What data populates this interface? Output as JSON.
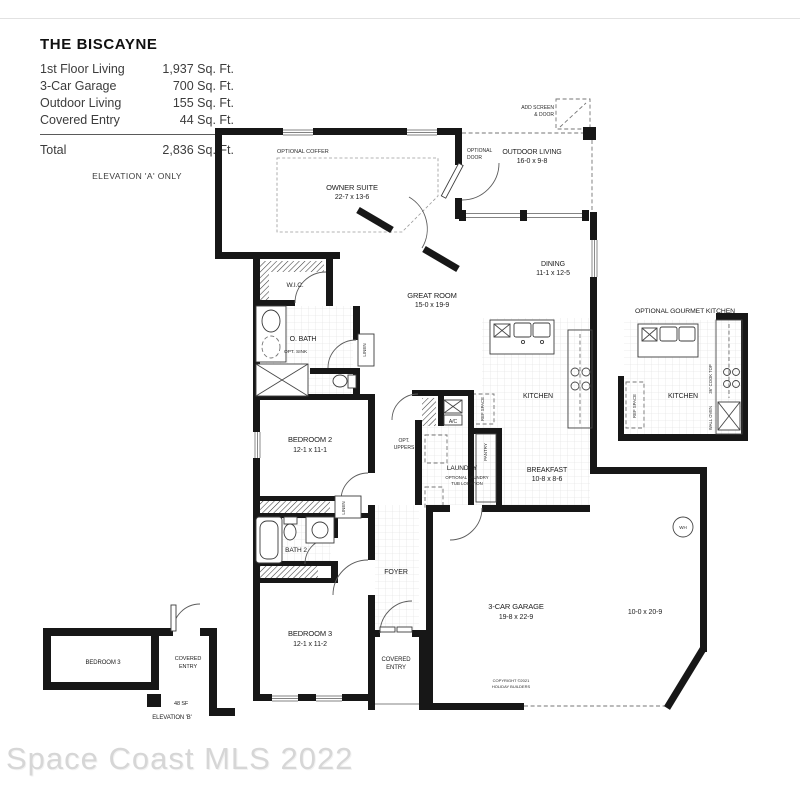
{
  "title_block": {
    "title": "THE BISCAYNE",
    "rows": [
      {
        "label": "1st Floor Living",
        "value": "1,937 Sq. Ft."
      },
      {
        "label": "3-Car Garage",
        "value": "700 Sq. Ft."
      },
      {
        "label": "Outdoor Living",
        "value": "155 Sq. Ft."
      },
      {
        "label": "Covered Entry",
        "value": "44 Sq. Ft."
      }
    ],
    "total_label": "Total",
    "total_value": "2,836 Sq. Ft.",
    "elevation_note": "ELEVATION 'A' ONLY"
  },
  "rooms": {
    "owner_suite": "OWNER SUITE",
    "owner_suite_dims": "22-7 x 13-6",
    "great_room": "GREAT ROOM",
    "great_room_dims": "15-0 x 19-9",
    "dining": "DINING",
    "dining_dims": "11-1 x 12-5",
    "outdoor_living": "OUTDOOR LIVING",
    "outdoor_living_dims": "16-0 x 9-8",
    "kitchen": "KITCHEN",
    "breakfast": "BREAKFAST",
    "breakfast_dims": "10-8 x 8-6",
    "bedroom2": "BEDROOM 2",
    "bedroom2_dims": "12-1 x 11-1",
    "bedroom3": "BEDROOM 3",
    "bedroom3_dims": "12-1 x 11-2",
    "bath2": "BATH 2",
    "o_bath": "O. BATH",
    "wic": "W.I.C.",
    "laundry": "LAUNDRY",
    "foyer": "FOYER",
    "garage": "3-CAR GARAGE",
    "garage_dims": "19-8 x 22-9",
    "garage_bay_dims": "10-0 x 20-9",
    "covered_line1": "COVERED",
    "covered_line2": "ENTRY"
  },
  "annotations": {
    "optional_coffer": "OPTIONAL COFFER",
    "optional_door_line1": "OPTIONAL",
    "optional_door_line2": "DOOR",
    "add_screen_line1": "ADD SCREEN",
    "add_screen_line2": "& DOOR",
    "opt_sink": "OPT. SINK",
    "opt_uppers_line1": "OPT.",
    "opt_uppers_line2": "UPPERS",
    "optional_laundry_line1": "OPTIONAL LAUNDRY",
    "optional_laundry_line2": "TUB LOCATION",
    "linen": "LINEN",
    "pantry": "PANTRY",
    "ref_space": "REF SPACE",
    "ac": "A/C",
    "wh": "WH",
    "cook_top": "36\" COOK TOP",
    "wall_oven": "WALL OVEN",
    "gourmet_title": "OPTIONAL GOURMET KITCHEN",
    "copyright_line1": "COPYRIGHT ©2021",
    "copyright_line2": "HOLIDAY BUILDERS"
  },
  "inset_b": {
    "sf": "48 SF",
    "elevation": "ELEVATION 'B'"
  },
  "watermark": "Space Coast MLS 2022"
}
